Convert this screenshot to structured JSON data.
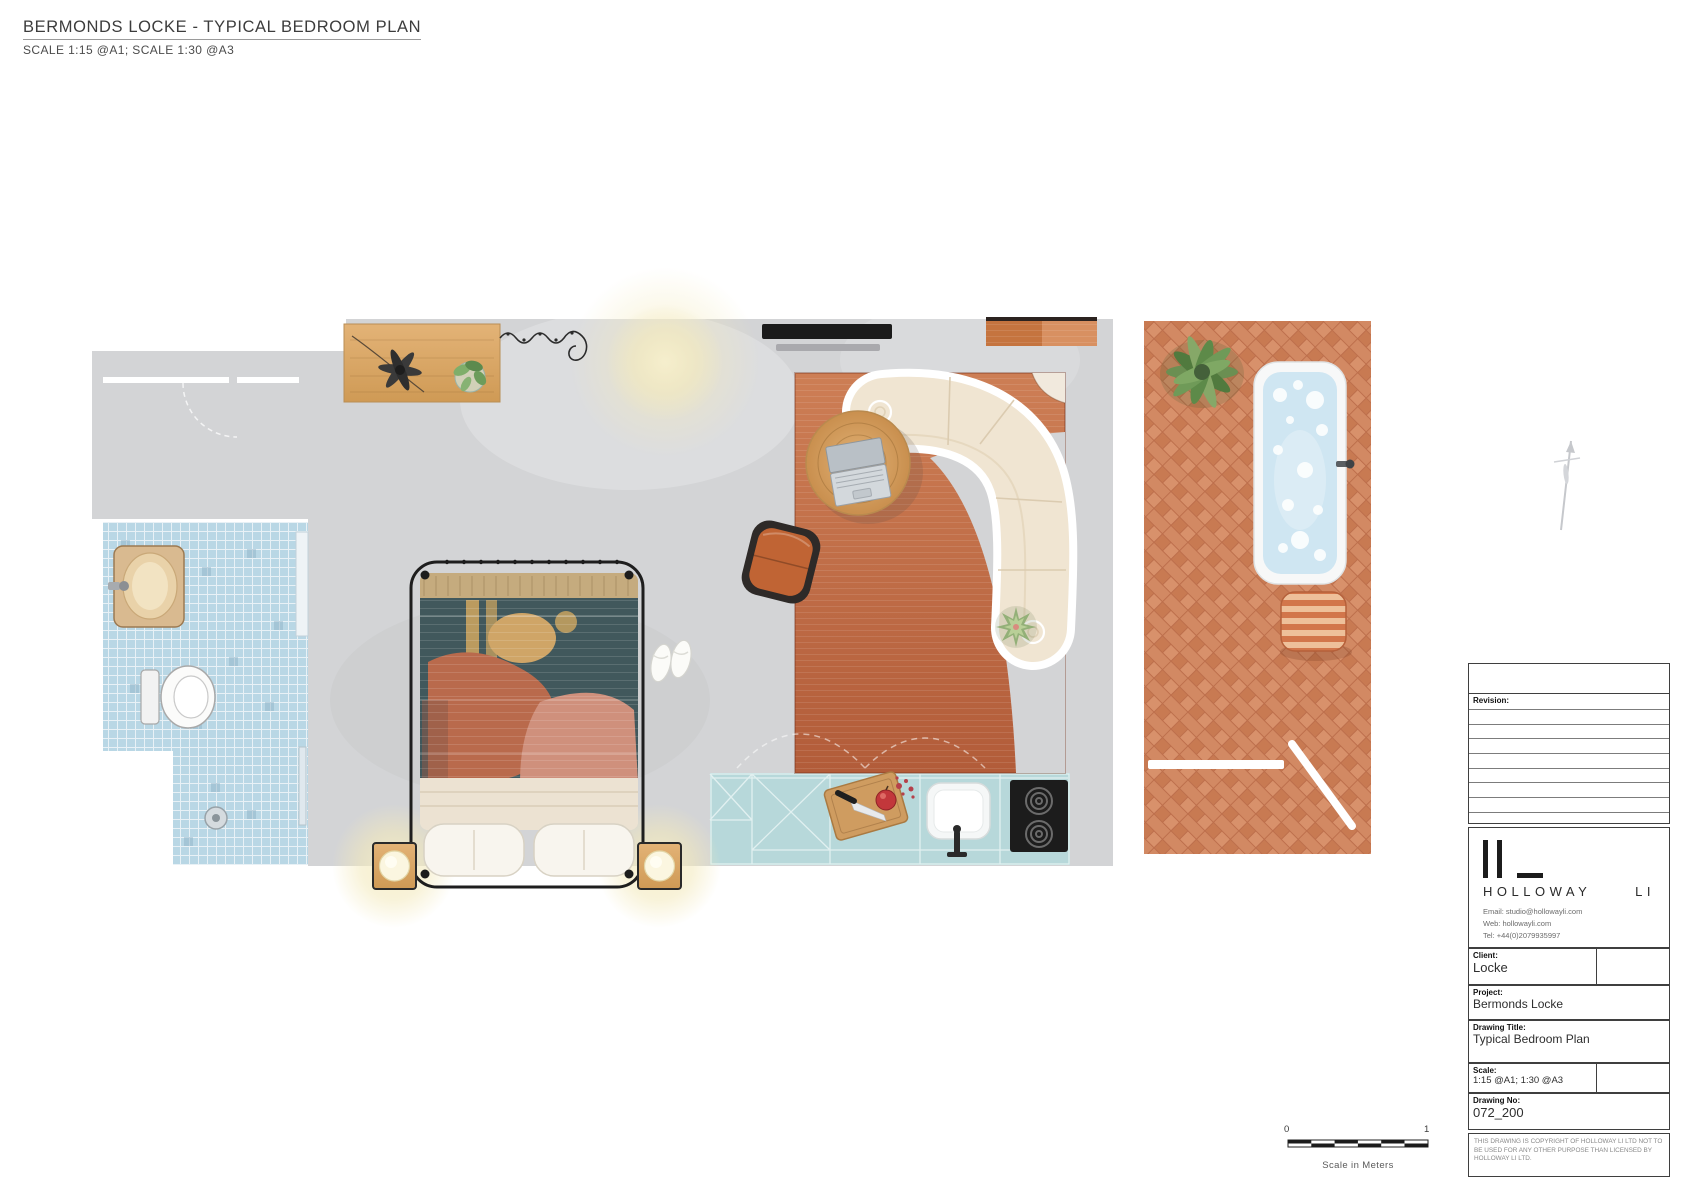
{
  "header": {
    "title": "BERMONDS LOCKE - TYPICAL BEDROOM PLAN",
    "subtitle": "SCALE 1:15 @A1; SCALE 1:30 @A3"
  },
  "title_block": {
    "revision_label": "Revision:",
    "logo": {
      "wordmark": "HOLLOWAY",
      "suffix": "LI"
    },
    "contact": {
      "email": "Email: studio@hollowayli.com",
      "web": "Web: hollowayli.com",
      "tel": "Tel: +44(0)2079935997"
    },
    "fields": {
      "client_label": "Client:",
      "client_value": "Locke",
      "project_label": "Project:",
      "project_value": "Bermonds Locke",
      "drawing_title_label": "Drawing Title:",
      "drawing_title_value": "Typical Bedroom Plan",
      "scale_label": "Scale:",
      "scale_value": "1:15 @A1; 1:30 @A3",
      "drawing_no_label": "Drawing No:",
      "drawing_no_value": "072_200"
    },
    "copyright": "THIS DRAWING IS COPYRIGHT OF HOLLOWAY LI LTD NOT TO BE USED FOR ANY OTHER PURPOSE THAN LICENSED BY HOLLOWAY LI LTD."
  },
  "scale_bar": {
    "start": "0",
    "end": "1",
    "caption": "Scale in Meters"
  },
  "plan": {
    "icons": [
      "table-fan-icon",
      "potted-plant-icon",
      "curtain-icon",
      "ceiling-light-icon",
      "tv-icon",
      "doormat-icon",
      "rug-icon",
      "curved-sofa-icon",
      "coffee-table-icon",
      "laptop-icon",
      "pouf-icon",
      "succulent-icon",
      "canopy-bed-icon",
      "pillow-icon",
      "bedside-lamp-icon",
      "slippers-icon",
      "kitchen-counter-icon",
      "cutting-board-icon",
      "knife-icon",
      "apple-icon",
      "sink-icon",
      "hob-icon",
      "vanity-sink-icon",
      "toilet-icon",
      "shower-drain-icon",
      "bathtub-icon",
      "garden-plant-icon",
      "striped-stool-icon",
      "north-needle-icon",
      "scale-bar-icon"
    ],
    "colors": {
      "floor_gray": "#d3d4d6",
      "tile_blue": "#b9d7e5",
      "kitchen_teal": "#b7d8da",
      "rug_terracotta": "#c26b44",
      "terrace_brick": "#cf8463",
      "sofa_cream": "#f0e5d2",
      "wood": "#d9a660",
      "blanket_teal": "#41585c",
      "accent_orange": "#c06434",
      "lamp_glow": "#f4ecc4",
      "water_blue": "#cfe6f2"
    }
  }
}
